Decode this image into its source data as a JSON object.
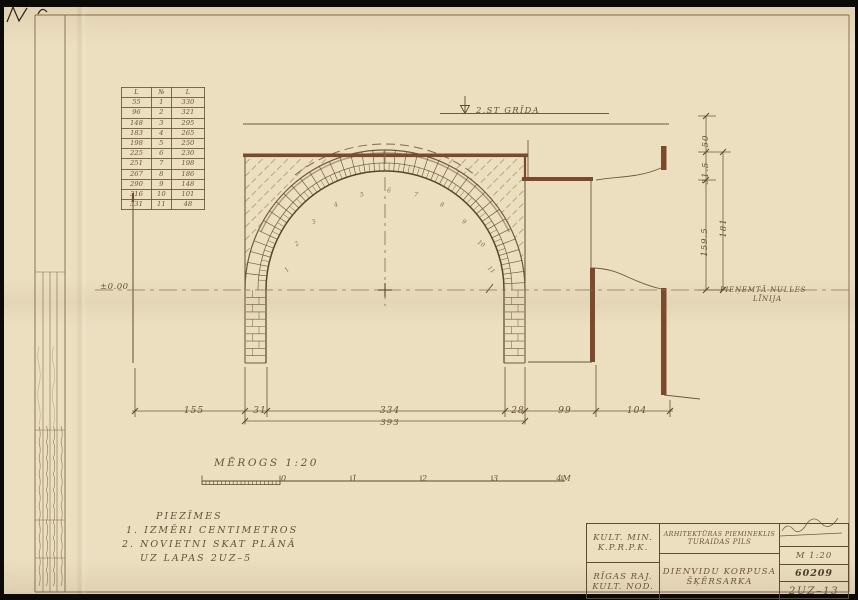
{
  "sheet": {
    "floor_label": "2.ST GRĪDA",
    "zero_label": "±0.00",
    "null_line_label_1": "PIEŅEMTĀ NULLES",
    "null_line_label_2": "LĪNIJA"
  },
  "colors": {
    "paper": "#ecdfc0",
    "ink": "#5a4a31",
    "pencil": "#7e6a46",
    "wall_brown": "#7b4a2c"
  },
  "measure_table": {
    "headers": [
      "L",
      "№",
      "L"
    ],
    "rows": [
      [
        "55",
        "1",
        "330"
      ],
      [
        "96",
        "2",
        "321"
      ],
      [
        "148",
        "3",
        "295"
      ],
      [
        "183",
        "4",
        "265"
      ],
      [
        "198",
        "5",
        "250"
      ],
      [
        "225",
        "6",
        "230"
      ],
      [
        "251",
        "7",
        "198"
      ],
      [
        "267",
        "8",
        "186"
      ],
      [
        "290",
        "9",
        "148"
      ],
      [
        "316",
        "10",
        "101"
      ],
      [
        "331",
        "11",
        "48"
      ]
    ]
  },
  "arch_points": [
    "1",
    "2",
    "3",
    "4",
    "5",
    "6",
    "7",
    "8",
    "9",
    "10",
    "11"
  ],
  "dims_bottom": [
    "155",
    "31",
    "334",
    "28",
    "99",
    "104"
  ],
  "dim_span": "393",
  "dims_right": {
    "d1": "50",
    "d2": "31.5",
    "d3": "159.5",
    "d4": "181"
  },
  "scale_bar": {
    "title": "MĒROGS 1:20",
    "ticks": [
      "0",
      "1",
      "2",
      "3",
      "4M"
    ]
  },
  "notes": {
    "title": "PIEZĪMES",
    "line1": "1. IZMĒRI CENTIMETROS",
    "line2": "2. NOVIETNI SKAT PLĀNĀ",
    "line3": "UZ LAPAS 2UZ–5"
  },
  "title_block": {
    "org_line1": "KULT. MIN.",
    "org_line2": "K.P.R.P.K.",
    "org_line3": "RĪGAS RAJ.",
    "org_line4": "KULT. NOD.",
    "monument_line1": "ARHITEKTŪRAS PIEMINEKLIS",
    "monument_line2": "TURAIDAS PILS",
    "drawing_line1": "DIENVIDU KORPUSA",
    "drawing_line2": "ŠĶĒRSARKA",
    "scale": "M 1:20",
    "inventory_no": "60209",
    "sheet_no": "2UZ–13"
  }
}
